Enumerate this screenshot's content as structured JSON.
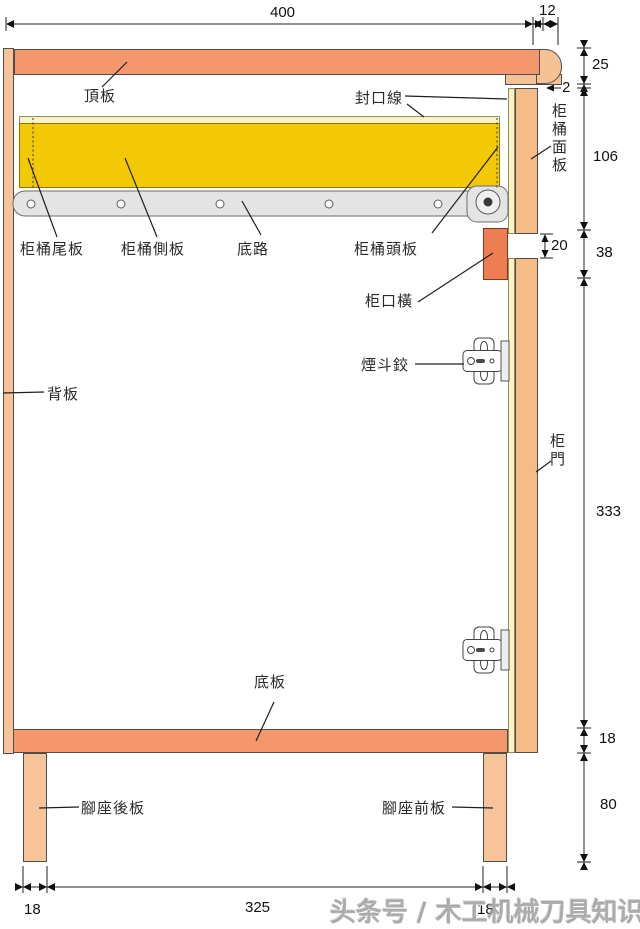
{
  "labels": {
    "top_board": "頂板",
    "seal_line": "封口線",
    "drawer_face_panel": "柜桶面板",
    "drawer_tail_board": "柜桶尾板",
    "drawer_side_board": "柜桶側板",
    "bottom_rail": "底路",
    "drawer_head_board": "柜桶頭板",
    "cabinet_opening_rail": "柜口橫",
    "hinge": "煙斗鉸",
    "back_board": "背板",
    "door": "柜門",
    "bottom_board": "底板",
    "rear_leg_board": "腳座後板",
    "front_leg_board": "腳座前板"
  },
  "dimensions": {
    "top_width": "400",
    "top_overhang": "12",
    "right_top_thickness": "25",
    "right_gap": "2",
    "right_drawer_front": "106",
    "right_reveal": "20",
    "right_opening_rail": "38",
    "right_door": "333",
    "right_bottom_thickness": "18",
    "right_leg_height": "80",
    "bottom_left_leg": "18",
    "bottom_span": "325",
    "bottom_right_leg": "18"
  },
  "watermark": "头条号 / 木工机械刀具知识",
  "colors": {
    "board_orange": "#F4976C",
    "wood_light": "#F6C498",
    "panel_orange": "#F6BC88",
    "opening_rail_accent": "#EF7D52",
    "drawer_yellow": "#F3C805",
    "seal_pale_yellow": "#FBF2C6",
    "rail_grey": "#E4E4E4",
    "line_dark": "#1f1f1f"
  }
}
